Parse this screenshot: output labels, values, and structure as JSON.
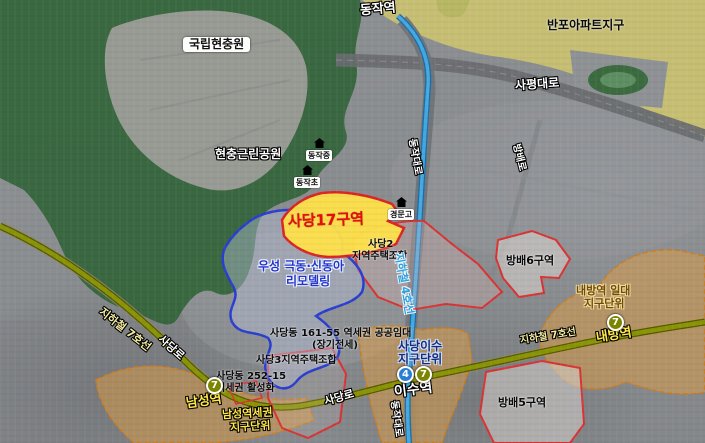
{
  "stations": {
    "dongjak": "동작역",
    "namseong": "남성역",
    "isu": "이수역",
    "naebang": "내방역"
  },
  "subway": {
    "line4_label": "지하철 4호선",
    "line7_label": "지하철 7호선",
    "line4_badge": "4",
    "line7_badge": "7"
  },
  "roads": {
    "sapyeong_daero": "사평대로",
    "dongjak_daero": "동작대로",
    "sadang_ro": "사당로",
    "bangbae_ro": "방배로"
  },
  "parks": {
    "national_cemetery": "국립현충원",
    "hyeonchung_park": "현충근린공원"
  },
  "schools": {
    "dongjak_middle": "동작중",
    "dongjak_elementary": "동작초",
    "gyeongmun_high": "경문고"
  },
  "zones": {
    "banpo_apartment": "반포아파트지구",
    "sadang17": "사당17구역",
    "sadang2_line1": "사당2",
    "sadang2_line2": "지역주택조합",
    "woosung_line1": "우성 극동·신동아",
    "woosung_line2": "리모델링",
    "sadang161_line1": "사당동 161-55 역세권 공공임대",
    "sadang161_line2": "(장기전세)",
    "sadang3": "사당3지역주택조합",
    "sadang252_line1": "사당동 252-15",
    "sadang252_line2": "역세권 활성화",
    "namseong_line1": "남성역세권",
    "namseong_line2": "지구단위",
    "sadang_isu_line1": "사당이수",
    "sadang_isu_line2": "지구단위",
    "naebang_line1": "내방역 일대",
    "naebang_line2": "지구단위",
    "bangbae6": "방배6구역",
    "bangbae5": "방배5구역"
  },
  "colors": {
    "line4": "#45a8e0",
    "line7": "#8a9406",
    "sadang17_fill": "#ffe24a",
    "redevelopment_border": "#d93434",
    "remodeling_border": "#2a3fd0",
    "district_unit_fill": "#e29e42",
    "district_unit_border": "#cf7d1c",
    "park_green": "#2f6336",
    "banpo_fill": "#d5cb6b"
  }
}
